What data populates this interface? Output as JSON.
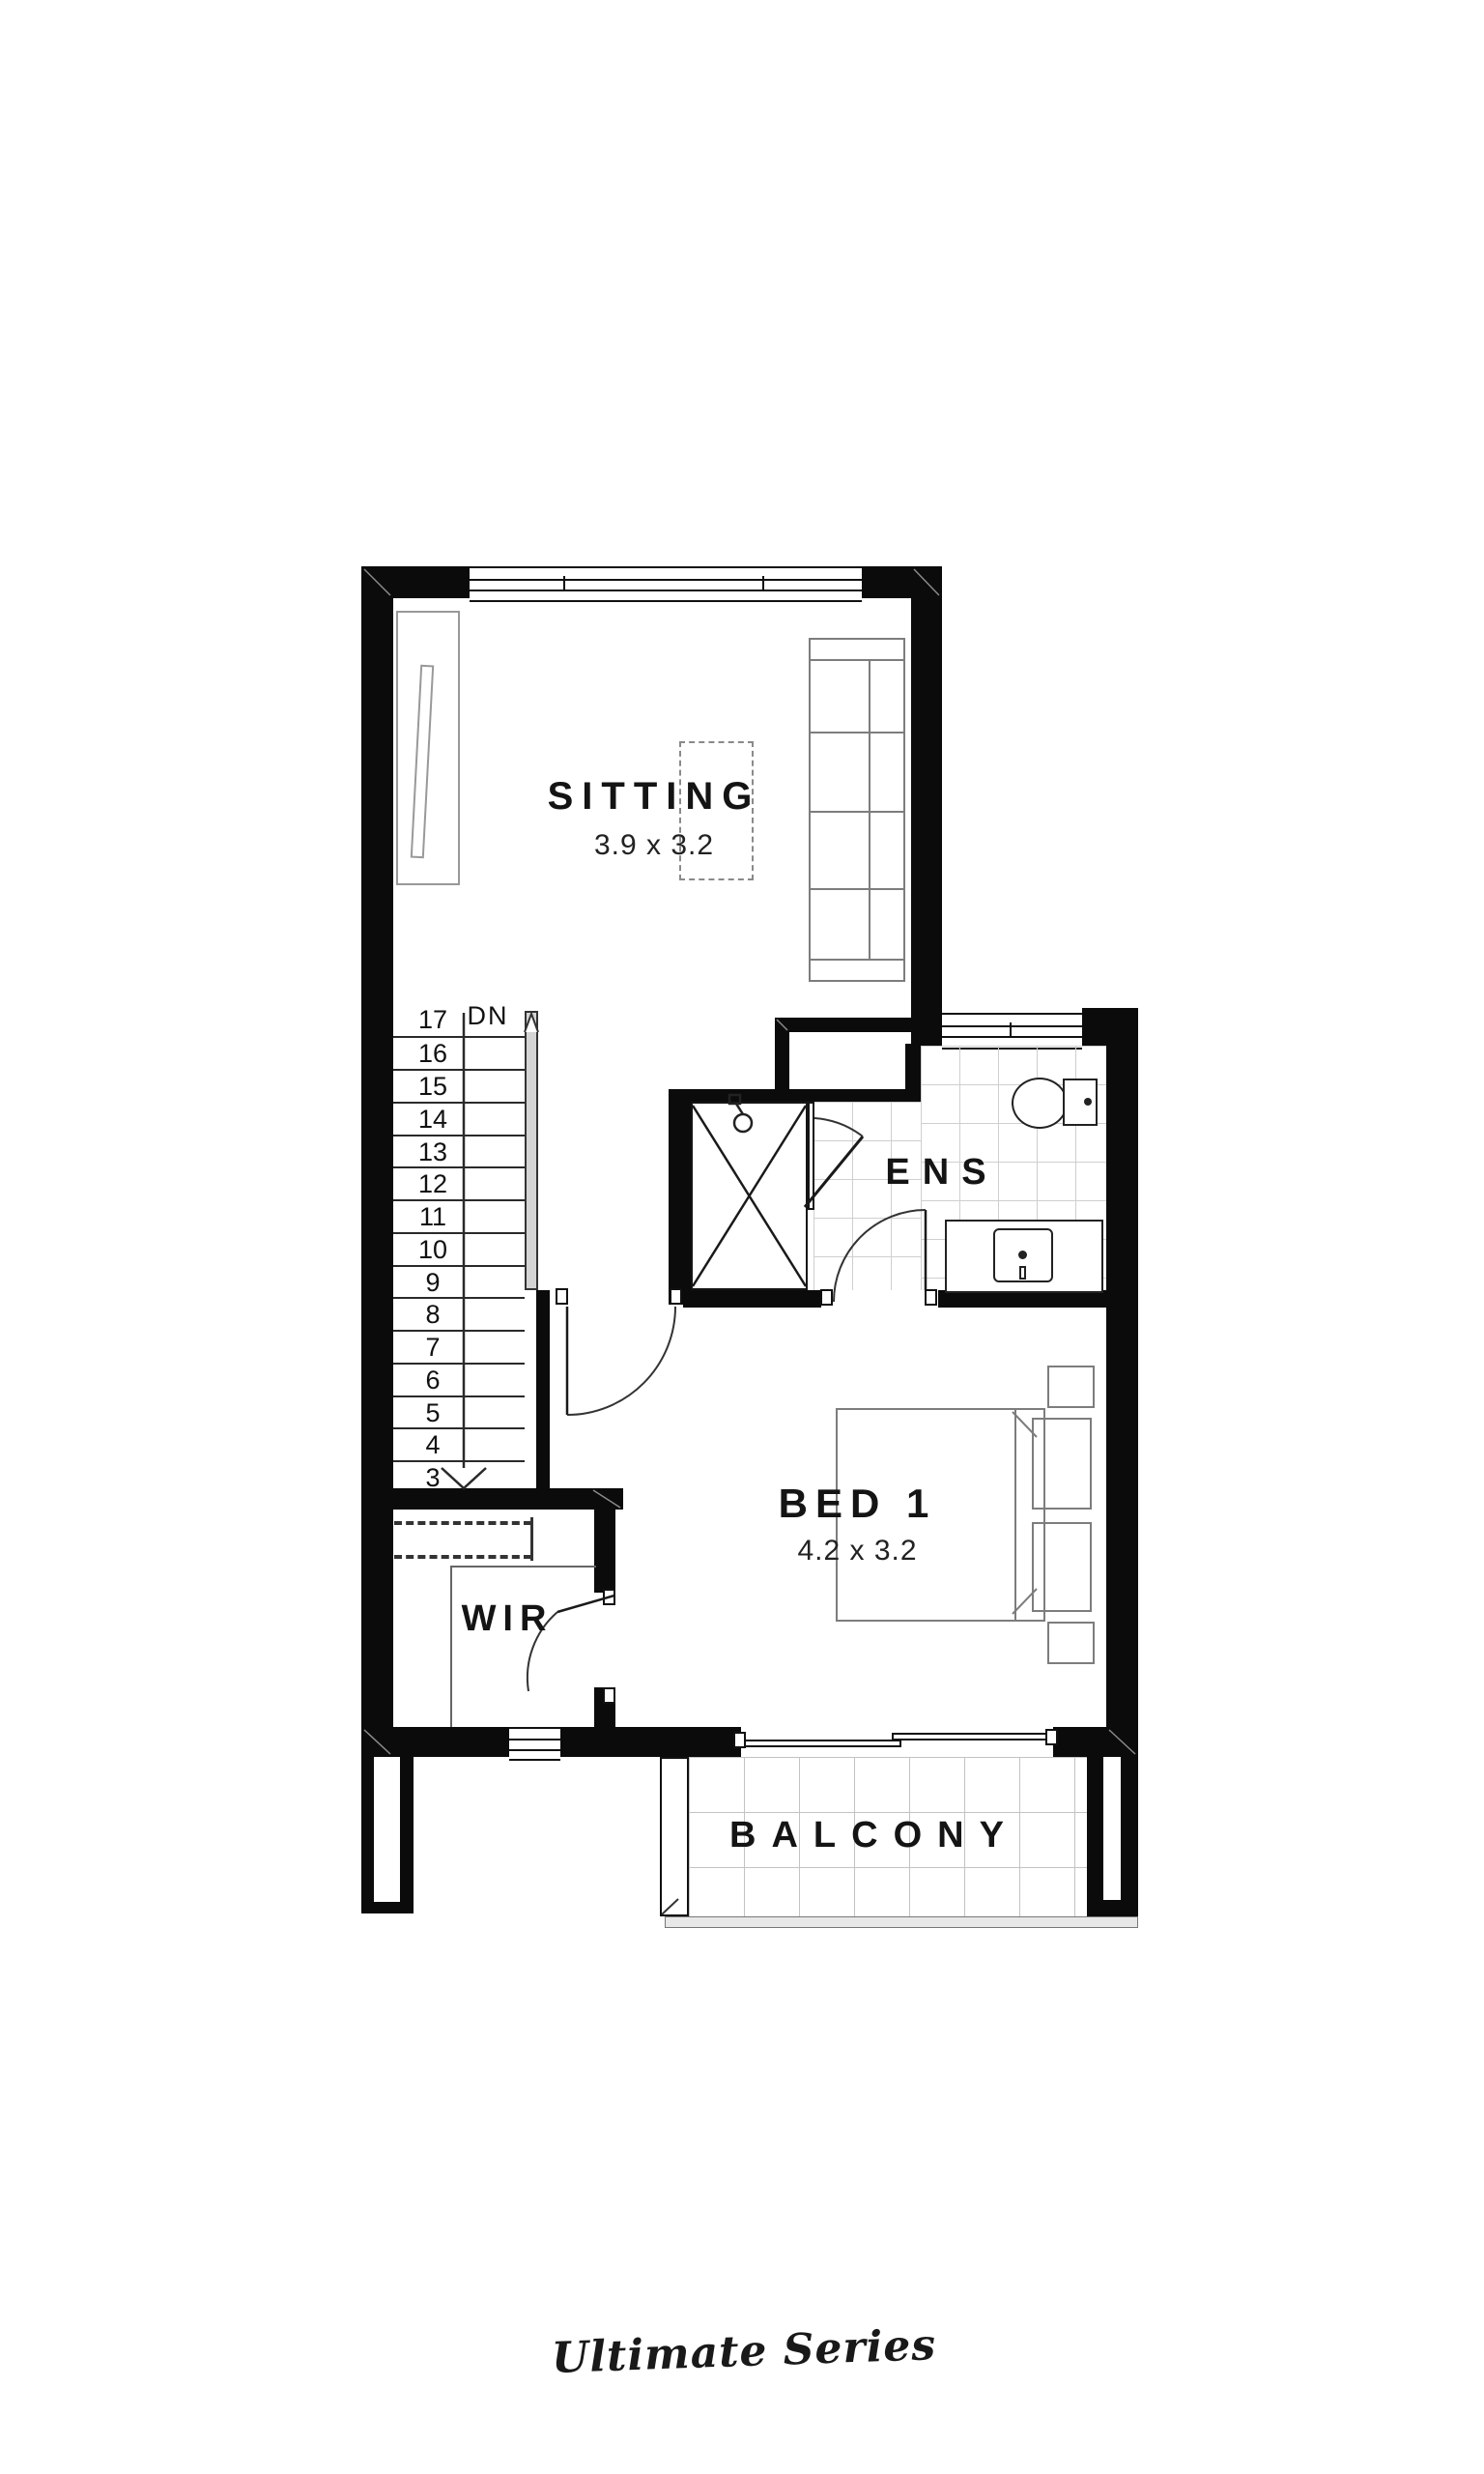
{
  "plan": {
    "rooms": {
      "sitting": {
        "name": "SITTING",
        "dims": "3.9 x 3.2"
      },
      "ens": {
        "name": "ENS"
      },
      "bed1": {
        "name": "BED 1",
        "dims": "4.2 x 3.2"
      },
      "wir": {
        "name": "WIR"
      },
      "balcony": {
        "name": "BALCONY"
      }
    },
    "stairs": {
      "top_step": "17",
      "direction_label": "DN",
      "steps": [
        "16",
        "15",
        "14",
        "13",
        "12",
        "11",
        "10",
        "9",
        "8",
        "7",
        "6",
        "5",
        "4",
        "3"
      ]
    },
    "colors": {
      "wall": "#0b0b0b",
      "line": "#2a2a2a",
      "furniture_line": "#7d7d7d",
      "tile_line": "#cfcfcf",
      "rail_fill": "#d4d4d4",
      "deck_edge": "#e8e8e8"
    }
  },
  "footer": {
    "brand": "Ultimate Series"
  }
}
